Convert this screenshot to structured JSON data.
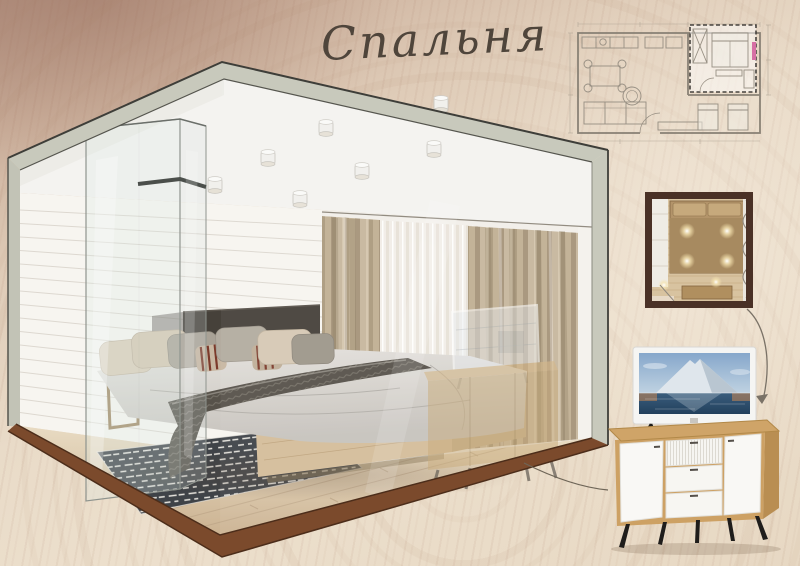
{
  "board": {
    "title": "Спальня",
    "kind_label": "interior-design-presentation-board"
  },
  "palette": {
    "titleInk": "#4f453b",
    "paperDark": "#b99a89",
    "paperLight": "#ecdfcc",
    "slabGray": "#c8c9bc",
    "slabBrown": "#7b4a2c",
    "outline": "#3e3e39",
    "shiplap": "#f7f5f0",
    "floorWoodBack": "#e9dcc4",
    "floorWoodFront": "#cbb291",
    "oak": "#d4bd9a",
    "headboard": "#46413a",
    "throw": "#57524a",
    "rug": "#3f4348",
    "drape": "#c0af93",
    "sheer": "#f3f0ea",
    "planFrame": "#4a3126",
    "planBed": "#b3946a",
    "accentPink": "#d66fa4",
    "planLine": "#968e82",
    "tvSkyTop": "#86a7cb",
    "tvSkyHorizon": "#c3d5e3",
    "tvWater": "#2e4f6e",
    "tvSunset": "#d68c50",
    "sideboardOak": "#cda164",
    "sideboardWhite": "#f8f7f4",
    "legBlack": "#1f1d1b"
  },
  "sections": {
    "room_view": {
      "label": "bedroom-3d-cutaway-render",
      "elements": [
        "glass-dressing-box",
        "double-bed",
        "upholstered-headboard",
        "knit-throw",
        "patterned-rug",
        "sheer-curtain",
        "drape-curtains",
        "ceiling-downlights",
        "ghost-tv-dresser",
        "shiplap-wall",
        "wood-plank-floor"
      ]
    },
    "floor_plan": {
      "label": "apartment-floor-plan-drawing",
      "highlighted_room": "bedroom"
    },
    "plan_detail": {
      "label": "bedroom-furniture-plan-top-view",
      "features": [
        "bed-with-pillows",
        "wardrobe",
        "curtain-wave",
        "dresser",
        "downlight-glows",
        "door-opening"
      ]
    },
    "tv_detail": {
      "label": "flat-screen-tv-mountain-lake-image"
    },
    "sideboard_detail": {
      "label": "white-oak-sideboard-black-splayed-legs",
      "features": [
        "left-door",
        "ribbed-top-drawer",
        "two-plain-drawers",
        "right-door"
      ]
    }
  }
}
